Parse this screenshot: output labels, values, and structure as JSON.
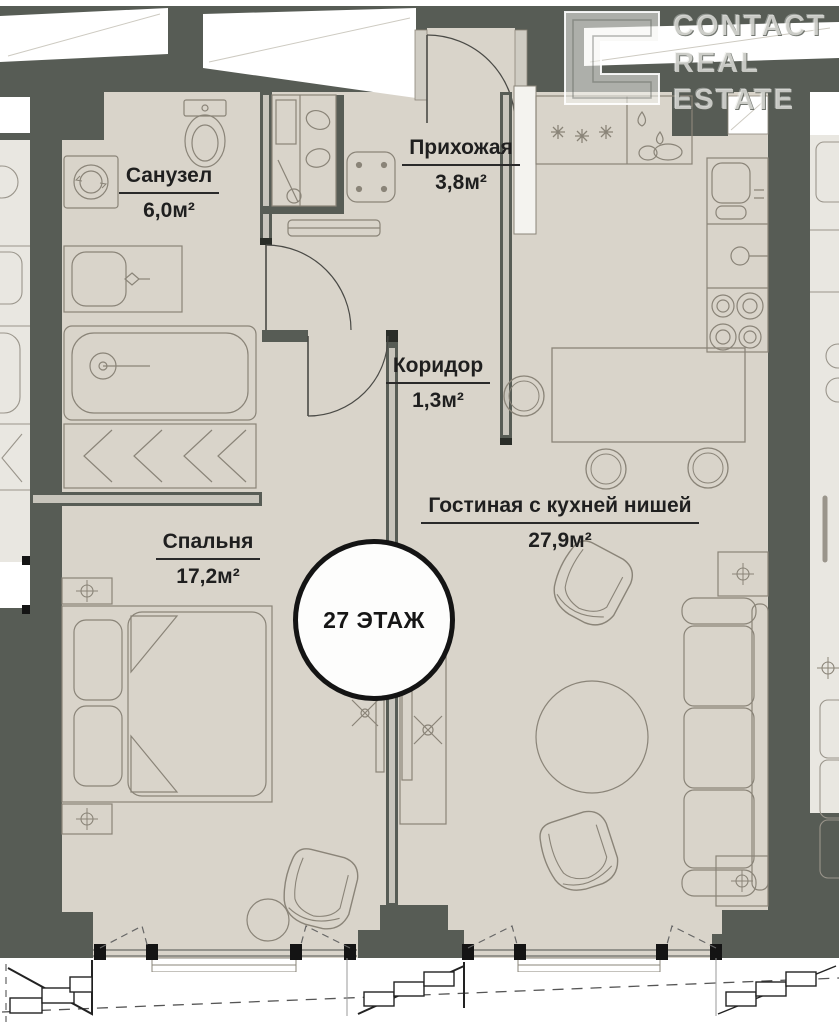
{
  "branding": {
    "logo_line1": "CONTACT",
    "logo_line2": "REAL",
    "logo_line3": "ESTATE",
    "logomark": "c-logo"
  },
  "floor_badge": {
    "label": "27 ЭТАЖ"
  },
  "rooms": {
    "bathroom": {
      "name": "Санузел",
      "area": "6,0м²"
    },
    "hallway": {
      "name": "Прихожая",
      "area": "3,8м²"
    },
    "corridor": {
      "name": "Коридор",
      "area": "1,3м²"
    },
    "bedroom": {
      "name": "Спальня",
      "area": "17,2м²"
    },
    "living": {
      "name": "Гостиная с кухней нишей",
      "area": "27,9м²"
    }
  },
  "colors": {
    "wall": "#575c55",
    "floor": "#d9d4ca",
    "neighbor_floor": "#e9e7e1",
    "outline": "#8a8478",
    "window": "#ffffff",
    "text": "#1f1f1f"
  }
}
